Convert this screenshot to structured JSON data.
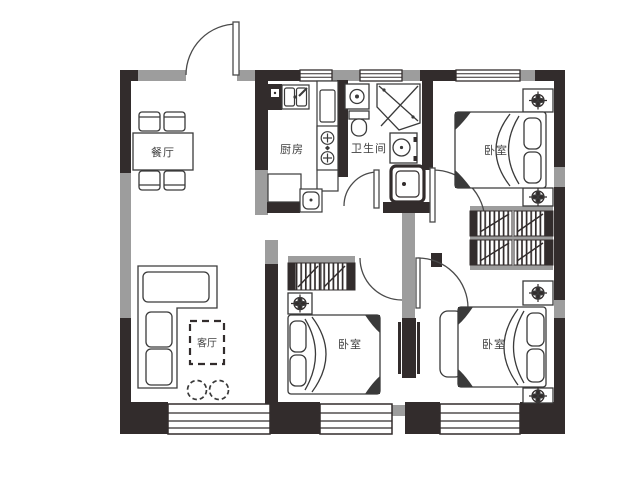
{
  "plan": {
    "type": "apartment-floor-plan",
    "rooms": {
      "dining": {
        "label": "餐厅"
      },
      "kitchen": {
        "label": "厨房"
      },
      "bathroom": {
        "label": "卫生间"
      },
      "bedroom_top": {
        "label": "卧室"
      },
      "living": {
        "label": "客厅"
      },
      "bedroom_mid": {
        "label": "卧室"
      },
      "bedroom_right": {
        "label": "卧室"
      }
    },
    "icons": {
      "nightstand_plant": "plant-pot-symbol",
      "stove": "two-burner-cooktop",
      "sink": "double-basin-sink",
      "shower": "corner-shower",
      "toilet": "toilet",
      "washer": "washing-machine",
      "mop_pool": "mop-basin",
      "wardrobe": "hatched-wardrobe"
    },
    "colors": {
      "wall_dark": "#322c2c",
      "wall_gray": "#9d9d9d",
      "line": "#3a3a3a",
      "background": "#ffffff"
    }
  }
}
